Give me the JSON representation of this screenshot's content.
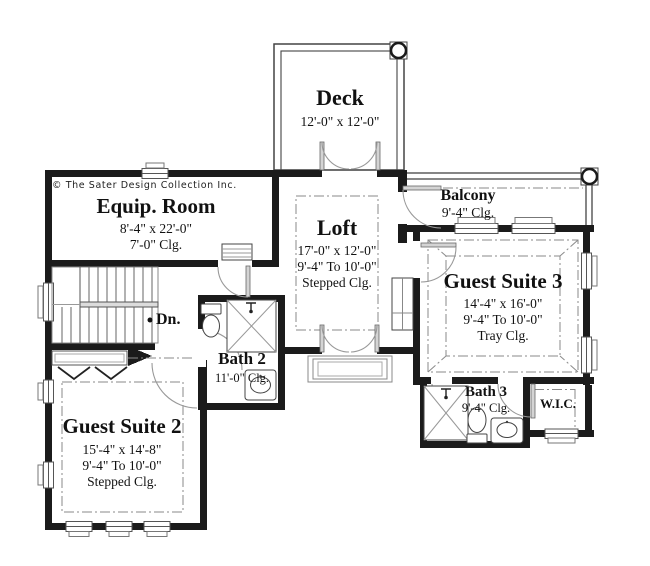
{
  "plan": {
    "copyright": "© The Sater Design Collection Inc.",
    "stair_label": "Dn.",
    "rooms": {
      "deck": {
        "name": "Deck",
        "dims": "12'-0\" x  12'-0\""
      },
      "equip_room": {
        "name": "Equip. Room",
        "dims": "8'-4\" x  22'-0\"",
        "ceiling": "7'-0\"  Clg."
      },
      "loft": {
        "name": "Loft",
        "dims": "17'-0\" x  12'-0\"",
        "ceiling_range": "9'-4\"  To 10'-0\"",
        "ceiling": "Stepped Clg."
      },
      "balcony": {
        "name": "Balcony",
        "ceiling": "9'-4\" Clg."
      },
      "guest_suite_3": {
        "name": "Guest Suite 3",
        "dims": "14'-4\" x  16'-0\"",
        "ceiling_range": "9'-4\"  To 10'-0\"",
        "ceiling": "Tray Clg."
      },
      "bath_2": {
        "name": "Bath 2",
        "ceiling": "11'-0\" Clg."
      },
      "bath_3": {
        "name": "Bath 3",
        "ceiling": "9'-4\" Clg."
      },
      "wic": {
        "name": "W.I.C."
      },
      "guest_suite_2": {
        "name": "Guest Suite 2",
        "dims": "15'-4\" x  14'-8\"",
        "ceiling_range": "9'-4\"  To 10'-0\"",
        "ceiling": "Stepped Clg."
      }
    },
    "colors": {
      "wall": "#1b1b1b",
      "thin_line": "#555555",
      "dash_line": "#8a8a8a",
      "background": "#ffffff"
    }
  }
}
